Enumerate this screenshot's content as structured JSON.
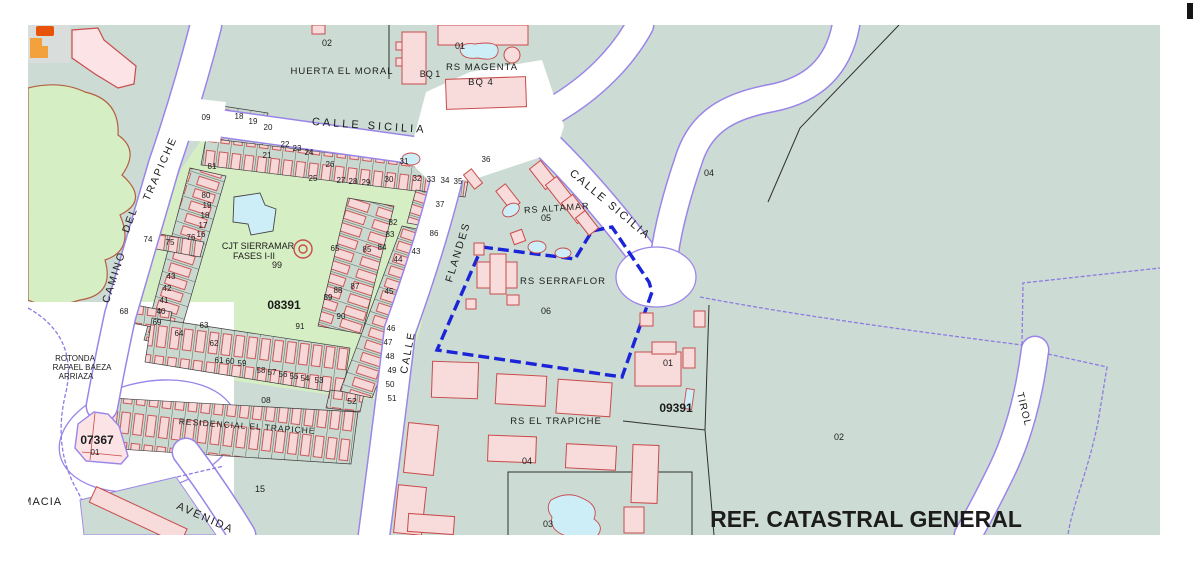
{
  "map": {
    "title_overlay": "REF. CATASTRAL GENERAL",
    "colors": {
      "base": "#ccdcd4",
      "green_zone": "#d6eec3",
      "road_casing": "#9a85e8",
      "building_fill": "#f8dbdb",
      "building_stroke": "#c94b4b",
      "pool": "#cdeef7",
      "highlight_boundary": "#1b24d8",
      "block_code": "#8d7de4",
      "rustic_outline": "#b3603f",
      "icon_orange": "#e65309",
      "icon_amber": "#f2a13d"
    },
    "street_labels": [
      {
        "t": "CALLE SICILIA",
        "x": 369,
        "y": 129,
        "r": 4,
        "s": 11,
        "ls": 3
      },
      {
        "t": "CALLE SICILIA",
        "x": 608,
        "y": 207,
        "r": 40,
        "s": 11,
        "ls": 2
      },
      {
        "t": "CAMINO",
        "x": 117,
        "y": 278,
        "r": -72,
        "s": 10.5,
        "ls": 2
      },
      {
        "t": "DEL",
        "x": 133,
        "y": 221,
        "r": -70,
        "s": 10.5,
        "ls": 2
      },
      {
        "t": "TRAPICHE",
        "x": 163,
        "y": 170,
        "r": -66,
        "s": 10.5,
        "ls": 2
      },
      {
        "t": "FLANDES",
        "x": 461,
        "y": 253,
        "r": -73,
        "s": 10.5,
        "ls": 2
      },
      {
        "t": "CALLE",
        "x": 411,
        "y": 353,
        "r": -79,
        "s": 10.5,
        "ls": 2
      },
      {
        "t": "AVENIDA",
        "x": 204,
        "y": 521,
        "r": 24,
        "s": 11,
        "ls": 2
      },
      {
        "t": "TIROL",
        "x": 1021,
        "y": 410,
        "r": 76,
        "s": 10,
        "ls": 1
      },
      {
        "t": "FARMACIA",
        "x": 30,
        "y": 505,
        "r": 0,
        "s": 11,
        "ls": 1
      }
    ],
    "area_labels": [
      {
        "t": "HUERTA EL MORAL",
        "x": 342,
        "y": 74,
        "s": 9.5,
        "ls": 1
      },
      {
        "t": "02",
        "x": 327,
        "y": 46,
        "s": 9
      },
      {
        "t": "01",
        "x": 460,
        "y": 49,
        "s": 9
      },
      {
        "t": "RS MAGENTA",
        "x": 482,
        "y": 70,
        "s": 9.5,
        "ls": 1
      },
      {
        "t": "BQ 1",
        "x": 430,
        "y": 77,
        "s": 9
      },
      {
        "t": "BQ 4",
        "x": 481,
        "y": 85,
        "s": 9.5,
        "ls": 1
      },
      {
        "t": "04",
        "x": 709,
        "y": 176,
        "s": 9
      },
      {
        "t": "RS ALTAMAR",
        "x": 557,
        "y": 211,
        "r": -4,
        "s": 9,
        "ls": 1
      },
      {
        "t": "05",
        "x": 546,
        "y": 221,
        "s": 9
      },
      {
        "t": "RS SERRAFLOR",
        "x": 563,
        "y": 284,
        "s": 9.5,
        "ls": 1
      },
      {
        "t": "06",
        "x": 546,
        "y": 314,
        "s": 9
      },
      {
        "t": "01",
        "x": 668,
        "y": 366,
        "s": 9
      },
      {
        "t": "RS EL TRAPICHE",
        "x": 556,
        "y": 424,
        "s": 9.5,
        "ls": 1
      },
      {
        "t": "04",
        "x": 527,
        "y": 464,
        "s": 9
      },
      {
        "t": "03",
        "x": 548,
        "y": 527,
        "s": 9
      },
      {
        "t": "CJT SIERRAMAR",
        "x": 258,
        "y": 249,
        "s": 9
      },
      {
        "t": "FASES I-II",
        "x": 254,
        "y": 259,
        "s": 9
      },
      {
        "t": "99",
        "x": 277,
        "y": 268,
        "s": 9
      },
      {
        "t": "ROTONDA",
        "x": 75,
        "y": 361,
        "s": 8
      },
      {
        "t": "RAFAEL BAEZA",
        "x": 82,
        "y": 370,
        "s": 8
      },
      {
        "t": "ARRIAZA",
        "x": 76,
        "y": 379,
        "s": 8
      },
      {
        "t": "RESIDENCIAL EL TRAPICHE",
        "x": 247,
        "y": 429,
        "r": 4,
        "s": 8.5,
        "ls": 1
      },
      {
        "t": "08",
        "x": 266,
        "y": 403,
        "s": 8.5
      },
      {
        "t": "52",
        "x": 352,
        "y": 404,
        "s": 8.5
      },
      {
        "t": "15",
        "x": 260,
        "y": 492,
        "s": 9
      },
      {
        "t": "02",
        "x": 839,
        "y": 440,
        "s": 9
      },
      {
        "t": "REF. CATASTRAL GENERAL",
        "x": 866,
        "y": 527,
        "s": 23,
        "b": 1
      }
    ],
    "parcel_numbers": [
      {
        "t": "09",
        "x": 206,
        "y": 120
      },
      {
        "t": "18",
        "x": 239,
        "y": 119
      },
      {
        "t": "19",
        "x": 253,
        "y": 124
      },
      {
        "t": "20",
        "x": 268,
        "y": 130
      },
      {
        "t": "21",
        "x": 267,
        "y": 158
      },
      {
        "t": "22",
        "x": 285,
        "y": 147
      },
      {
        "t": "23",
        "x": 297,
        "y": 151
      },
      {
        "t": "24",
        "x": 309,
        "y": 155
      },
      {
        "t": "25",
        "x": 313,
        "y": 181
      },
      {
        "t": "26",
        "x": 330,
        "y": 167
      },
      {
        "t": "27",
        "x": 341,
        "y": 183
      },
      {
        "t": "28",
        "x": 353,
        "y": 184
      },
      {
        "t": "29",
        "x": 366,
        "y": 185
      },
      {
        "t": "30",
        "x": 389,
        "y": 182
      },
      {
        "t": "31",
        "x": 404,
        "y": 164
      },
      {
        "t": "32",
        "x": 417,
        "y": 181
      },
      {
        "t": "33",
        "x": 431,
        "y": 182
      },
      {
        "t": "34",
        "x": 445,
        "y": 183
      },
      {
        "t": "35",
        "x": 458,
        "y": 184
      },
      {
        "t": "36",
        "x": 486,
        "y": 162
      },
      {
        "t": "81",
        "x": 212,
        "y": 169
      },
      {
        "t": "80",
        "x": 206,
        "y": 198
      },
      {
        "t": "19",
        "x": 207,
        "y": 208
      },
      {
        "t": "18",
        "x": 205,
        "y": 218
      },
      {
        "t": "17",
        "x": 203,
        "y": 228
      },
      {
        "t": "16",
        "x": 201,
        "y": 237
      },
      {
        "t": "74",
        "x": 148,
        "y": 242
      },
      {
        "t": "75",
        "x": 170,
        "y": 245
      },
      {
        "t": "76",
        "x": 191,
        "y": 240
      },
      {
        "t": "43",
        "x": 171,
        "y": 279
      },
      {
        "t": "42",
        "x": 167,
        "y": 291
      },
      {
        "t": "41",
        "x": 164,
        "y": 303
      },
      {
        "t": "40",
        "x": 161,
        "y": 314
      },
      {
        "t": "69",
        "x": 157,
        "y": 325
      },
      {
        "t": "68",
        "x": 124,
        "y": 314
      },
      {
        "t": "63",
        "x": 204,
        "y": 328
      },
      {
        "t": "64",
        "x": 179,
        "y": 336
      },
      {
        "t": "62",
        "x": 214,
        "y": 346
      },
      {
        "t": "61",
        "x": 219,
        "y": 363
      },
      {
        "t": "60",
        "x": 230,
        "y": 364
      },
      {
        "t": "59",
        "x": 242,
        "y": 366
      },
      {
        "t": "58",
        "x": 261,
        "y": 373
      },
      {
        "t": "57",
        "x": 272,
        "y": 375
      },
      {
        "t": "56",
        "x": 283,
        "y": 377
      },
      {
        "t": "55",
        "x": 294,
        "y": 379
      },
      {
        "t": "54",
        "x": 305,
        "y": 381
      },
      {
        "t": "53",
        "x": 319,
        "y": 383
      },
      {
        "t": "65",
        "x": 335,
        "y": 251
      },
      {
        "t": "85",
        "x": 367,
        "y": 252
      },
      {
        "t": "84",
        "x": 382,
        "y": 250
      },
      {
        "t": "83",
        "x": 390,
        "y": 237
      },
      {
        "t": "82",
        "x": 393,
        "y": 225
      },
      {
        "t": "37",
        "x": 440,
        "y": 207
      },
      {
        "t": "86",
        "x": 434,
        "y": 236
      },
      {
        "t": "87",
        "x": 355,
        "y": 289
      },
      {
        "t": "88",
        "x": 338,
        "y": 293
      },
      {
        "t": "89",
        "x": 328,
        "y": 300
      },
      {
        "t": "90",
        "x": 341,
        "y": 319
      },
      {
        "t": "91",
        "x": 300,
        "y": 329
      },
      {
        "t": "43",
        "x": 416,
        "y": 254
      },
      {
        "t": "44",
        "x": 398,
        "y": 262
      },
      {
        "t": "45",
        "x": 389,
        "y": 294
      },
      {
        "t": "46",
        "x": 391,
        "y": 331
      },
      {
        "t": "47",
        "x": 388,
        "y": 345
      },
      {
        "t": "48",
        "x": 390,
        "y": 359
      },
      {
        "t": "49",
        "x": 392,
        "y": 373
      },
      {
        "t": "50",
        "x": 390,
        "y": 387
      },
      {
        "t": "51",
        "x": 392,
        "y": 401
      },
      {
        "t": "01",
        "x": 95,
        "y": 455
      }
    ],
    "block_codes": [
      {
        "t": "08391",
        "x": 284,
        "y": 309
      },
      {
        "t": "09391",
        "x": 676,
        "y": 412
      },
      {
        "t": "07367",
        "x": 97,
        "y": 444
      }
    ]
  }
}
